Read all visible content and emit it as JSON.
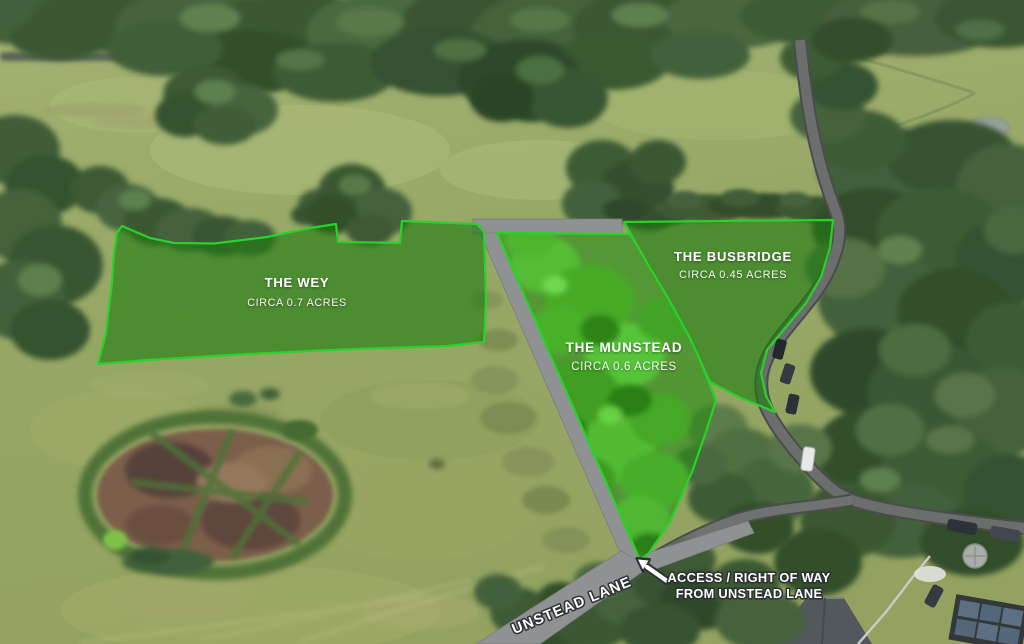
{
  "plots": [
    {
      "name": "THE WEY",
      "area": "CIRCA 0.7 ACRES"
    },
    {
      "name": "THE MUNSTEAD",
      "area": "CIRCA 0.6 ACRES"
    },
    {
      "name": "THE BUSBRIDGE",
      "area": "CIRCA 0.45 ACRES"
    }
  ],
  "lane": {
    "label": "UNSTEAD LANE"
  },
  "access": {
    "line1": "ACCESS / RIGHT OF WAY",
    "line2": "FROM UNSTEAD LANE"
  },
  "colors": {
    "plot_border": "#2bd12b",
    "plot_fill_overlay": "rgba(32,124,18,0.62)",
    "lane_gray": "#8f9192",
    "label_text": "#ffffff"
  }
}
